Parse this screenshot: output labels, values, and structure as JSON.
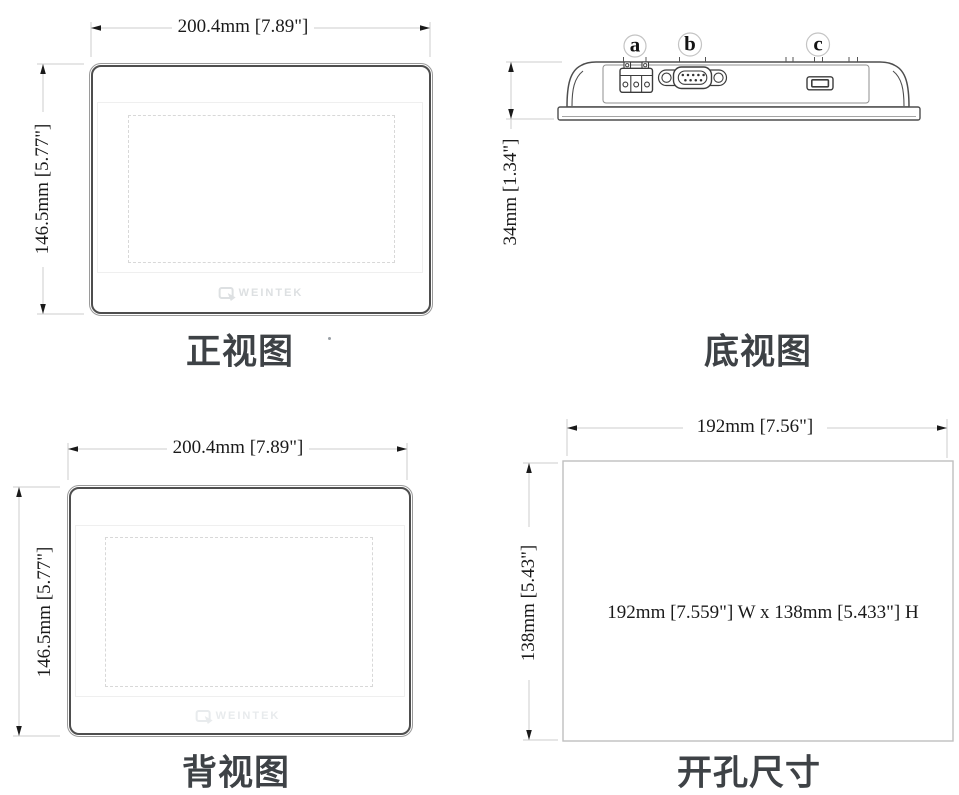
{
  "page": {
    "background": "#ffffff"
  },
  "colors": {
    "outline": "#4e4e4e",
    "thin_outline": "#8f8f8f",
    "dim_line": "#cccccc",
    "cutout_line": "#bfbfbf",
    "arrow": "#1a1a1a",
    "dim_text": "#1a1a1a",
    "title_text": "#3e4246",
    "dashed_line": "#d8d8d8",
    "port_label_circle": "#c4c4c4"
  },
  "views": {
    "front": {
      "title": "正视图",
      "width_label": "200.4mm [7.89\"]",
      "height_label": "146.5mm [5.77\"]",
      "logo_text": "WEINTEK"
    },
    "bottom": {
      "title": "底视图",
      "height_label": "34mm [1.34\"]",
      "port_labels": {
        "a": "a",
        "b": "b",
        "c": "c"
      }
    },
    "back": {
      "title": "背视图",
      "width_label": "200.4mm [7.89\"]",
      "height_label": "146.5mm [5.77\"]",
      "logo_text": "WEINTEK"
    },
    "cutout": {
      "title": "开孔尺寸",
      "width_label": "192mm [7.56\"]",
      "height_label": "138mm [5.43\"]",
      "note": "192mm [7.559\"] W x 138mm [5.433\"] H"
    }
  }
}
